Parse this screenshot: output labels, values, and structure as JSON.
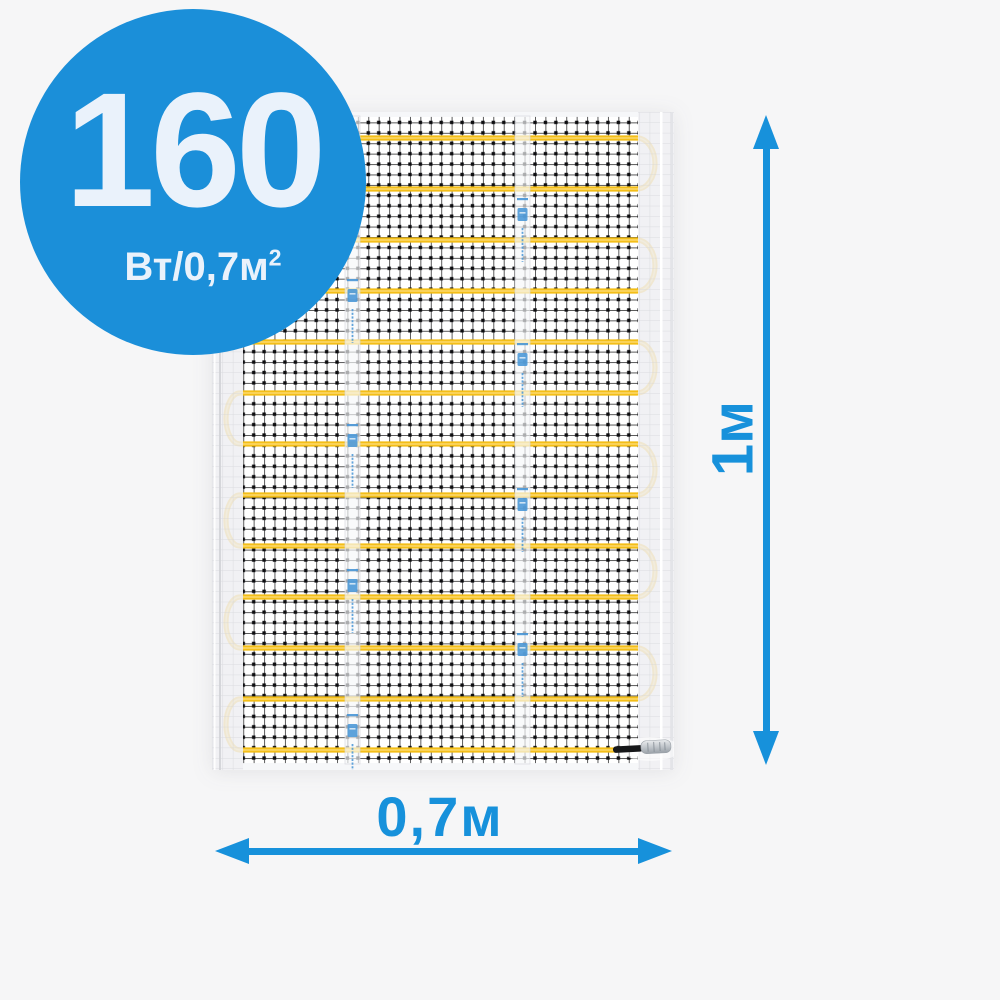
{
  "colors": {
    "background": "#f6f6f7",
    "accent": "#1791db",
    "badge_fill": "#1b8fd9",
    "badge_text": "#eaf2fb",
    "cable": "#f3be18",
    "cable_sheen": "#ffe084",
    "mesh": "#1d1d1f",
    "selvage": "rgba(238,239,242,0.85)",
    "tapemark": "#4795d6"
  },
  "badge": {
    "value": "160",
    "unit_base": "Вт/0,7м",
    "unit_exponent": "2"
  },
  "dimension_annotations": {
    "height_label": "1м",
    "width_label": "0,7м"
  },
  "mat": {
    "cable_rows": 13,
    "row_start_y": 26,
    "row_spacing": 51,
    "row_x_left": 28,
    "row_x_right": 425,
    "first_row_start_x": 16,
    "last_row_end_x": 404,
    "loop_rx_right": 18,
    "loop_rx_left": 14,
    "tape_width": 15,
    "tape_mark_period": 145,
    "tapes": [
      {
        "x": 140.5,
        "mark_offset": 22
      },
      {
        "x": 310.5,
        "mark_offset": 86
      }
    ]
  }
}
